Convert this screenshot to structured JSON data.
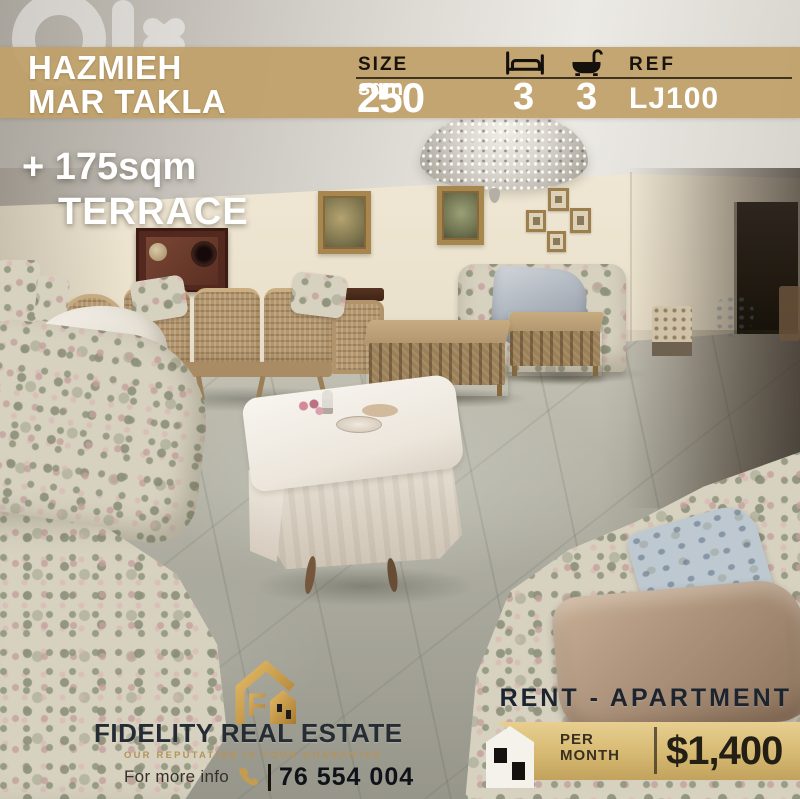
{
  "watermark": {
    "text": "olx"
  },
  "header": {
    "location_line1": "HAZMIEH",
    "location_line2": "MAR TAKLA",
    "size_label": "SIZE",
    "size_value": "250",
    "size_unit": "sqm",
    "bedrooms": "3",
    "bathrooms": "3",
    "ref_label": "REF",
    "ref_value": "LJ100"
  },
  "terrace": {
    "line1": "+ 175sqm",
    "line2": "TERRACE"
  },
  "brand": {
    "name": "FIDELITY REAL ESTATE",
    "tagline": "OUR REPUTATION IS YOUR GUARANTEE",
    "info_label": "For more info",
    "phone": "76 554 004"
  },
  "offer": {
    "listing_type": "RENT - APARTMENT",
    "per_line1": "PER",
    "per_line2": "MONTH",
    "price": "$1,400"
  },
  "colors": {
    "band_tan": "#C0A168",
    "ribbon_gold": "#D6B972",
    "logo_gold": "#C9984C",
    "tagline_gold": "#B3945A",
    "dark_navy_text": "#1C242F",
    "black_text": "#17140E",
    "white_text": "#FFFFFF"
  },
  "icons": {
    "watermark": "olx-watermark",
    "bedrooms": "bed-icon",
    "bathrooms": "bath-icon",
    "contact": "phone-icon",
    "brand_logo": "fidelity-house-logo-icon",
    "price_tag": "house-ribbon-icon"
  }
}
